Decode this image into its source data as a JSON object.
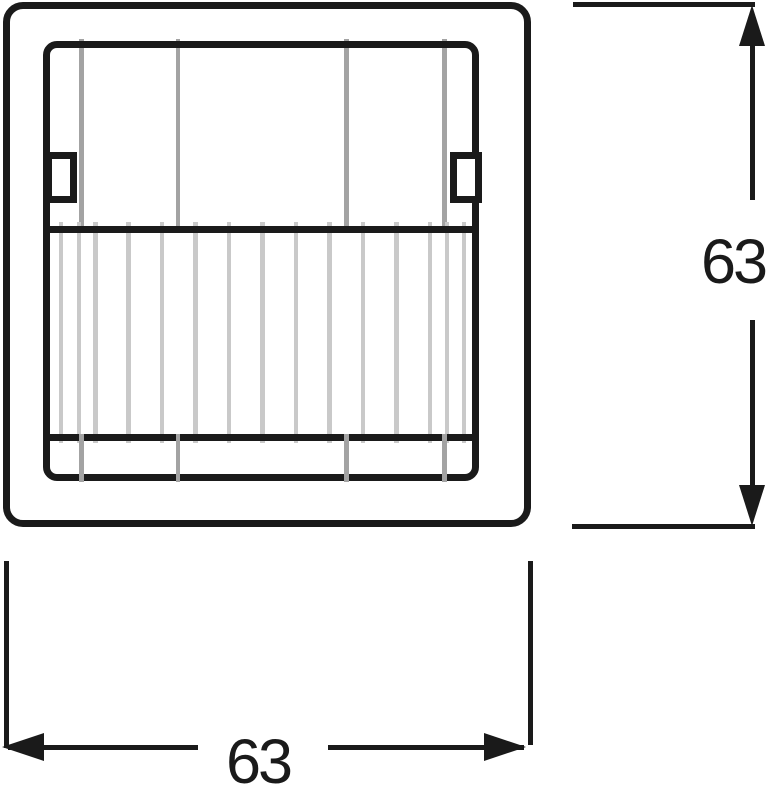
{
  "dimensions": {
    "height_label": "63",
    "width_label": "63"
  },
  "colors": {
    "line": "#1a1a1a",
    "guide_line_gray": "#a3a3a3",
    "lens_rib_gray": "#c9c9c9",
    "background": "#ffffff"
  },
  "figure": {
    "upper_guide_line_x": [
      81.5,
      178,
      346.5,
      444.5
    ],
    "lower_guide_line_x": [
      81.5,
      178,
      346.5,
      444.5
    ],
    "lens_rib_x": [
      61,
      79,
      95.5,
      128.5,
      162,
      195.5,
      229,
      262.5,
      296,
      329.5,
      363,
      396.5,
      430,
      447,
      464
    ]
  }
}
